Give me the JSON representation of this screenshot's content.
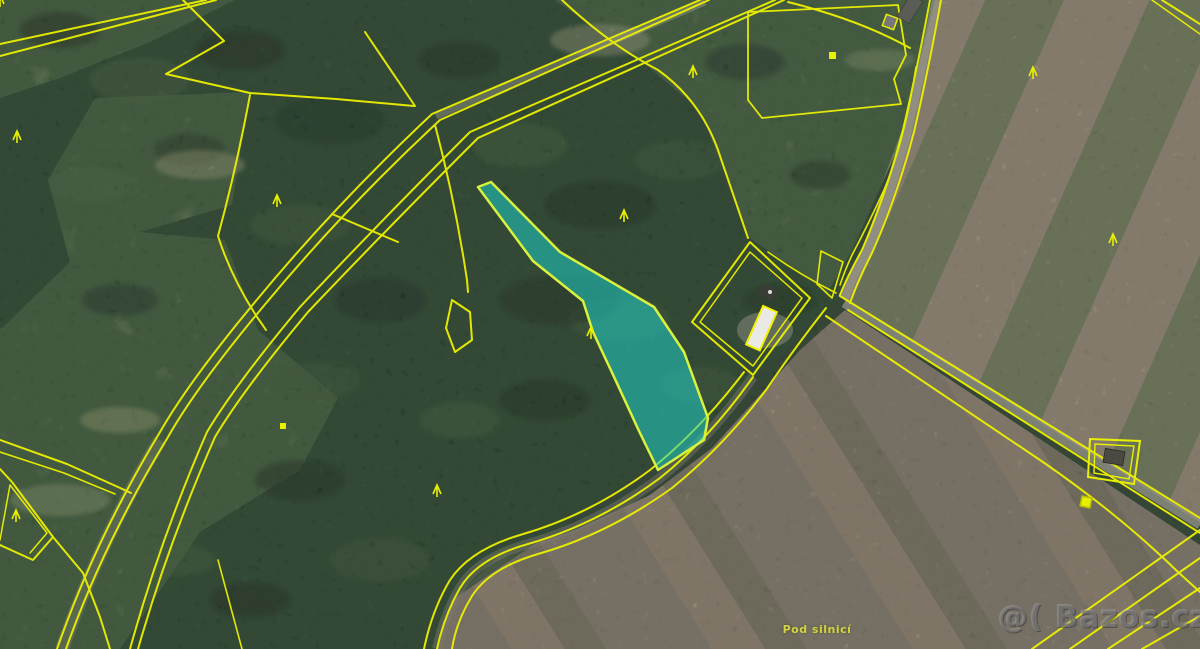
{
  "source": {
    "watermark_text": "@( Bazos.cz"
  },
  "map": {
    "kind": "aerial-cadastral-map",
    "place_label": "Pod silnicí",
    "boundary_line_color": "#ecf000",
    "road_fill_color": "#95958a",
    "highlighted_parcel": {
      "fill": "#1fd0c6",
      "fill_opacity": "0.55",
      "border": "#d9f23c",
      "description": "narrow wedge parcel widening to the south-east through forest"
    },
    "terrain_colors": {
      "forest": "#2c4530",
      "meadow": "#7d9763",
      "field_tan": "#a89a85",
      "field_green": "#7d8a67",
      "field_brown": "#94897a"
    },
    "symbols": {
      "tree_symbol": {
        "glyph": "Λ",
        "color": "#e8ef00",
        "count": 9
      },
      "square_marker": {
        "color": "#e8ef00",
        "count": 3
      }
    },
    "buildings": {
      "farm_building_roof": "#e9e9e6",
      "barn_roof": "#5c5c56",
      "small_building_roof": "#4a4a42"
    }
  }
}
